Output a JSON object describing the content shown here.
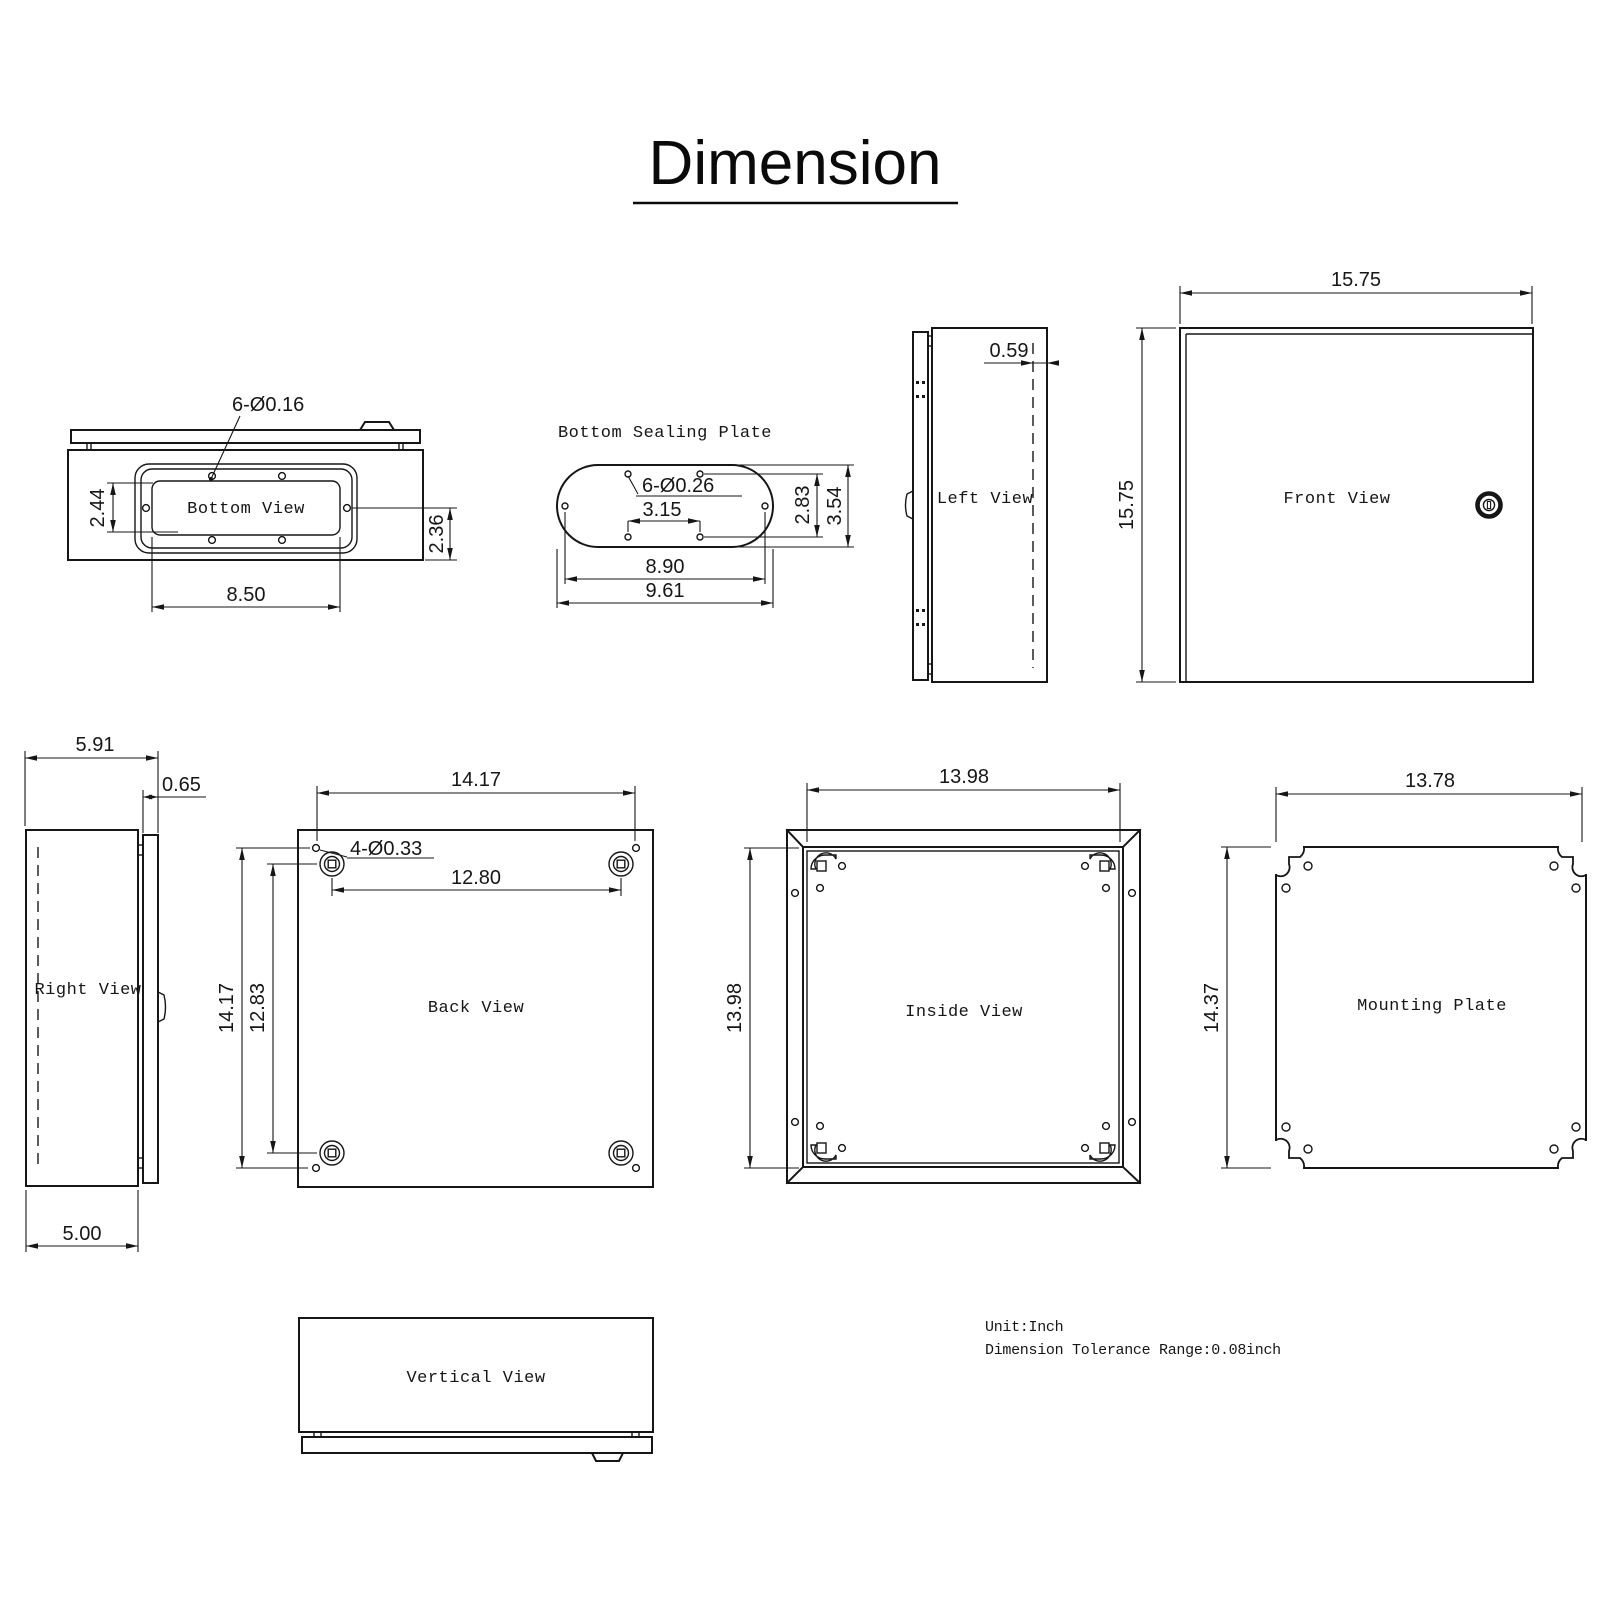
{
  "title": "Dimension",
  "notes": {
    "unit": "Unit:Inch",
    "tolerance": "Dimension Tolerance Range:0.08inch"
  },
  "views": {
    "bottom": {
      "label": "Bottom View",
      "hole_callout": "6-Ø0.16",
      "dim_cutout_height": "2.44",
      "dim_edge_offset": "2.36",
      "dim_cutout_width": "8.50"
    },
    "sealing_plate": {
      "label": "Bottom Sealing Plate",
      "hole_callout": "6-Ø0.26",
      "dim_hole_span_x": "3.15",
      "dim_hole_span_y": "2.83",
      "dim_height": "3.54",
      "dim_hole_width": "8.90",
      "dim_width": "9.61"
    },
    "left": {
      "label": "Left View",
      "dim_door_offset": "0.59"
    },
    "front": {
      "label": "Front View",
      "dim_width": "15.75",
      "dim_height": "15.75"
    },
    "right": {
      "label": "Right View",
      "dim_total_depth": "5.91",
      "dim_door_depth": "0.65",
      "dim_body_depth": "5.00"
    },
    "back": {
      "label": "Back View",
      "hole_callout": "4-Ø0.33",
      "dim_hole_span_x": "14.17",
      "dim_boss_span_x": "12.80",
      "dim_hole_span_y": "14.17",
      "dim_boss_span_y": "12.83"
    },
    "inside": {
      "label": "Inside View",
      "dim_width": "13.98",
      "dim_height": "13.98"
    },
    "mounting": {
      "label": "Mounting Plate",
      "dim_width": "13.78",
      "dim_height": "14.37"
    },
    "vertical": {
      "label": "Vertical View"
    }
  }
}
